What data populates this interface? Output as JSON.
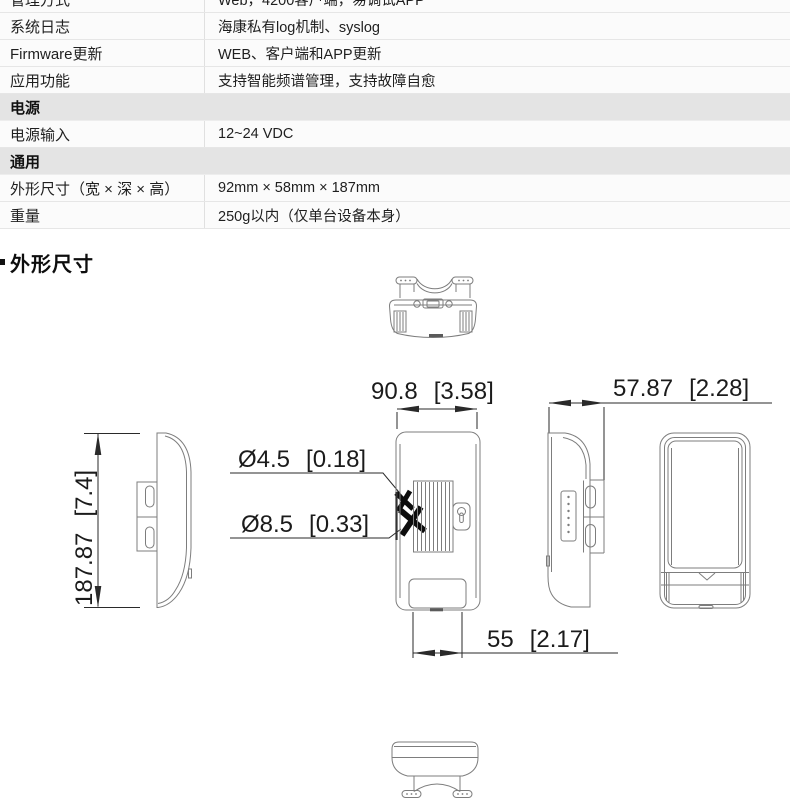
{
  "table": {
    "rows": [
      {
        "label": "管理方式",
        "value": "Web，4200客户端，易调试APP"
      },
      {
        "label": "系统日志",
        "value": "海康私有log机制、syslog"
      },
      {
        "label": "Firmware更新",
        "value": "WEB、客户端和APP更新"
      },
      {
        "label": "应用功能",
        "value": "支持智能频谱管理，支持故障自愈"
      },
      {
        "header": "电源"
      },
      {
        "label": "电源输入",
        "value": "12~24 VDC"
      },
      {
        "header": "通用"
      },
      {
        "label": "外形尺寸（宽 × 深 × 高）",
        "value": "92mm × 58mm × 187mm"
      },
      {
        "label": "重量",
        "value": "250g以内（仅单台设备本身）"
      }
    ]
  },
  "section": {
    "title": "外形尺寸"
  },
  "dimensions": {
    "width_top": {
      "mm": "90.8",
      "inch": "[3.58]"
    },
    "depth": {
      "mm": "57.87",
      "inch": "[2.28]"
    },
    "height": {
      "mm": "187.87",
      "inch": "[7.4]"
    },
    "hole_small": {
      "mm": "Ø4.5",
      "inch": "[0.18]"
    },
    "hole_large": {
      "mm": "Ø8.5",
      "inch": "[0.33]"
    },
    "bottom_width": {
      "mm": "55",
      "inch": "[2.17]"
    }
  }
}
